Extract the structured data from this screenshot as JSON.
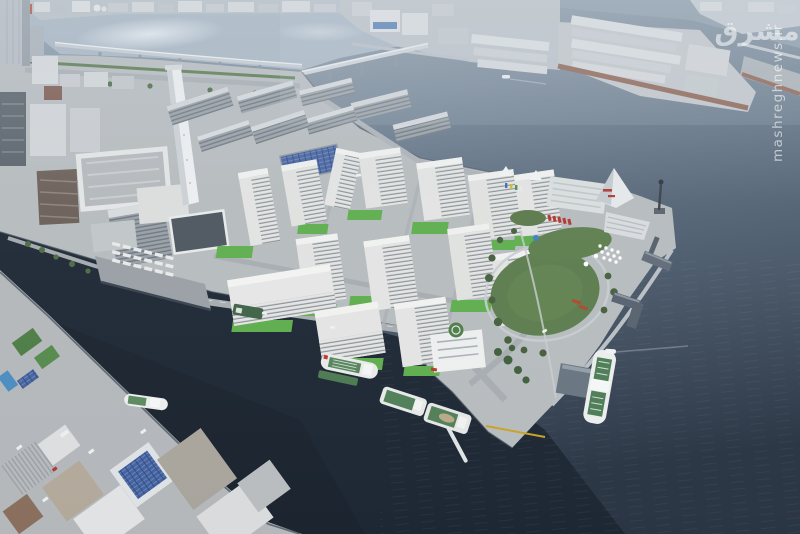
{
  "watermark": {
    "vertical_text": "mashreghnews.ir",
    "logo_text": "مشرق",
    "color": "#ffffff"
  },
  "scene": {
    "type": "aerial-photograph",
    "subject": "hazy daytime aerial view of a bay-front residential island with mid-rise apartment blocks, a green oval park, a pyramid-roofed ferry terminal, piers with moored green-deck work ships, bridges over the river, an industrial warehouse peninsula and a dark harbor basin",
    "palette": {
      "water_light": "#a8b6c3",
      "water_mid": "#5d6e80",
      "water_dark": "#1e2834",
      "land_concrete": "#b7bcbe",
      "road": "#a8adb1",
      "lawn_bright": "#5fae4e",
      "lawn_park": "#5c7c4d",
      "tree_green": "#465f3d",
      "building_white": "#e6e7e5",
      "building_gray": "#9aa1a7",
      "roof_solar_blue": "#45639f",
      "wharf_edge_brown": "#8a5c49",
      "boat_hull_white": "#e9ebea",
      "boat_deck_green": "#4e7d57",
      "accent_red": "#b5342b",
      "chimney_white": "#eef0f1"
    },
    "landmarks": [
      "river-bridge-west",
      "river-bridge-northeast",
      "white-chimney-tower",
      "north-apartment-rows",
      "residential-village-blocks",
      "oval-park-lawn",
      "pyramid-roof-terminal",
      "amphitheater-steps",
      "harbor-light-tower",
      "t-shaped-pier",
      "l-shaped-pier",
      "truck-depot-platform",
      "warehouse-peninsula",
      "helipad-building",
      "southwest-wharf",
      "harbor-basin",
      "docked-work-boats"
    ],
    "boats": {
      "count": 8,
      "hull_color": "#e9ebea",
      "deck_color": "#4e7d57"
    }
  }
}
